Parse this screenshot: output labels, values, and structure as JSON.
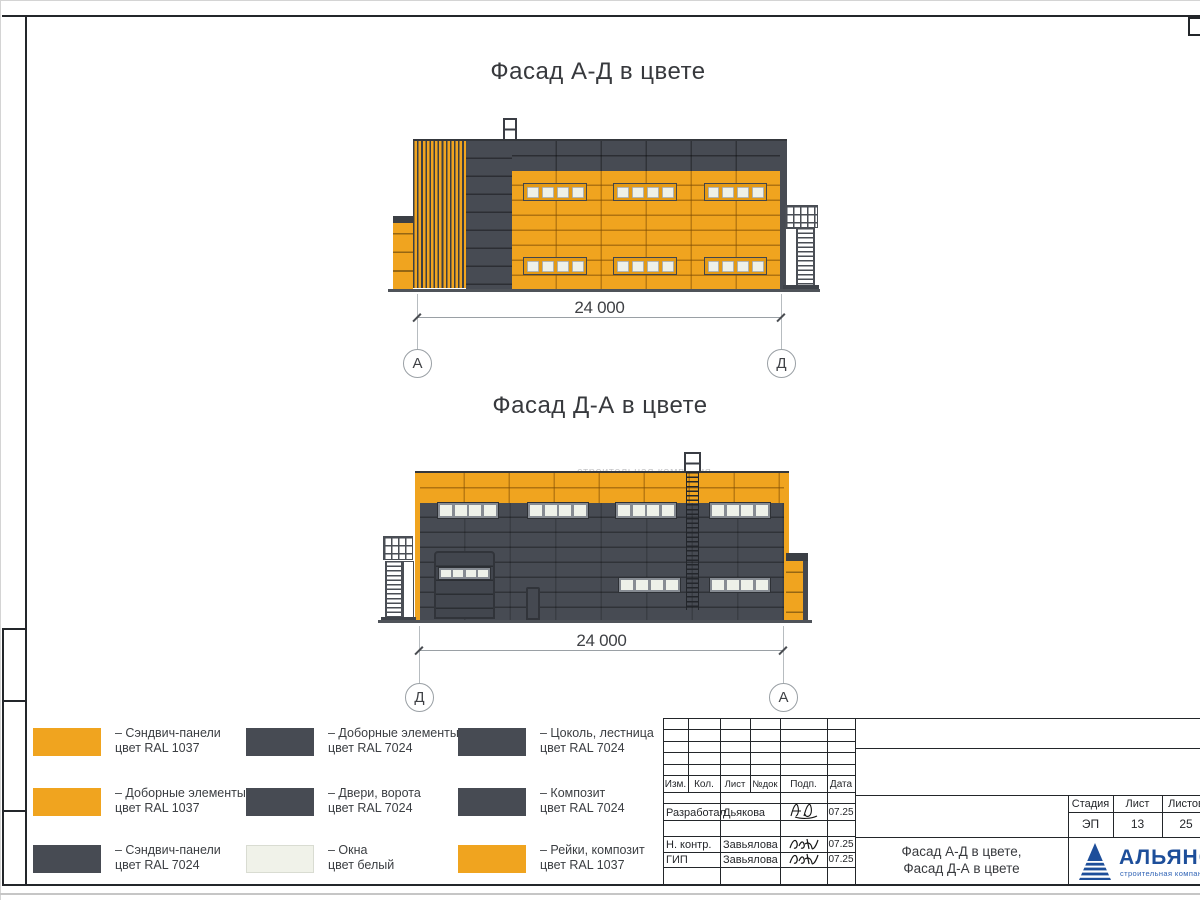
{
  "colors": {
    "orange_ral1037": "#F0A41F",
    "gray_ral7024": "#474B53",
    "window_white": "#EEF1E9",
    "logo_blue": "#1D4E9A"
  },
  "facade1": {
    "title": "Фасад А-Д в цвете",
    "dimension": "24 000",
    "axis_left": "А",
    "axis_right": "Д"
  },
  "facade2": {
    "title": "Фасад Д-А в цвете",
    "dimension": "24 000",
    "axis_left": "Д",
    "axis_right": "А",
    "watermark": "строительная компания"
  },
  "legend": {
    "items": [
      {
        "swatch": "orange",
        "hex": "#F0A41F",
        "line1": "– Сэндвич-панели",
        "line2": "цвет RAL 1037"
      },
      {
        "swatch": "dark",
        "hex": "#474B53",
        "line1": "– Доборные элементы",
        "line2": "цвет RAL 7024"
      },
      {
        "swatch": "dark",
        "hex": "#474B53",
        "line1": "– Цоколь, лестница",
        "line2": "цвет RAL 7024"
      },
      {
        "swatch": "orange",
        "hex": "#F0A41F",
        "line1": "– Доборные элементы",
        "line2": "цвет RAL 1037"
      },
      {
        "swatch": "dark",
        "hex": "#474B53",
        "line1": "– Двери, ворота",
        "line2": "цвет RAL 7024"
      },
      {
        "swatch": "dark",
        "hex": "#474B53",
        "line1": "– Композит",
        "line2": "цвет RAL 7024"
      },
      {
        "swatch": "dark",
        "hex": "#474B53",
        "line1": "– Сэндвич-панели",
        "line2": "цвет RAL 7024"
      },
      {
        "swatch": "white",
        "hex": "#F0F2E9",
        "line1": "– Окна",
        "line2": "цвет белый"
      },
      {
        "swatch": "orange",
        "hex": "#F0A41F",
        "line1": "– Рейки, композит",
        "line2": "цвет RAL 1037"
      }
    ]
  },
  "titleblock": {
    "rev_header": [
      "Изм.",
      "Кол.",
      "Лист",
      "№док",
      "Подп.",
      "Дата"
    ],
    "sign_rows": [
      {
        "role": "Разработал",
        "name": "Дьякова",
        "date": "07.25"
      },
      {
        "role": "Н. контр.",
        "name": "Завьялова",
        "date": "07.25"
      },
      {
        "role": "ГИП",
        "name": "Завьялова",
        "date": "07.25"
      }
    ],
    "stage_label": "Стадия",
    "sheet_label": "Лист",
    "sheets_label": "Листов",
    "stage": "ЭП",
    "sheet": "13",
    "sheets": "25",
    "doc_title_line1": "Фасад А-Д в цвете,",
    "doc_title_line2": "Фасад Д-А в цвете",
    "company_name": "АЛЬЯНС",
    "company_subtitle": "строительная компания"
  }
}
